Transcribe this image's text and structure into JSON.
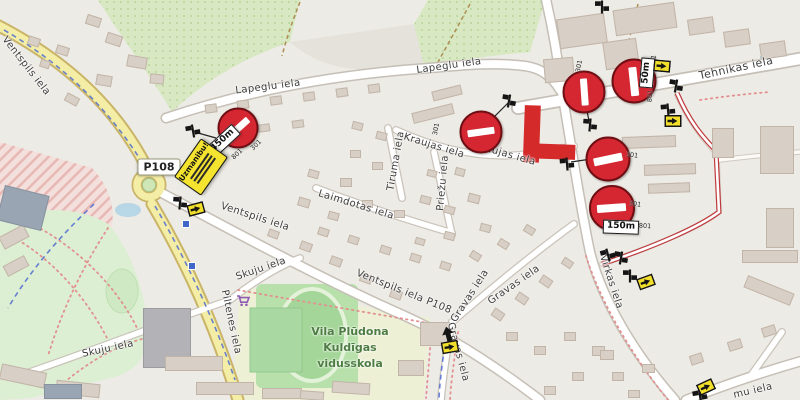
{
  "colors": {
    "closure": "#d42a2a",
    "route": "#bf3a3e",
    "no_entry": "#d42732",
    "detour_yellow": "#f2df2b",
    "warning_yellow": "#f4e32f",
    "primary_road": "#f3eda5",
    "school_text": "#4e7d43",
    "cycle_route": "#4f6bd0"
  },
  "badges": {
    "road_ref": "P108",
    "x": 159,
    "y": 167
  },
  "warning_sign": {
    "title": "Uzmanibu!",
    "x": 201,
    "y": 167,
    "rot": -55
  },
  "school_label": {
    "lines": [
      "Vila Plūdona",
      "Kuldīgas",
      "vidusskola"
    ],
    "x": 350,
    "y": 348
  },
  "street_labels": [
    {
      "id": "ventspils-nw",
      "text": "Ventspils iela",
      "x": 26,
      "y": 66,
      "rot": 52
    },
    {
      "id": "lapeglu-w",
      "text": "Lapeglu iela",
      "x": 268,
      "y": 87,
      "rot": -7
    },
    {
      "id": "lapeglu-e",
      "text": "Lapeglu iela",
      "x": 449,
      "y": 66,
      "rot": -8
    },
    {
      "id": "tehnikas",
      "text": "Tehnikas iela",
      "x": 736,
      "y": 68,
      "rot": -12,
      "size": 11
    },
    {
      "id": "kraujas-w",
      "text": "Kraujas iela",
      "x": 434,
      "y": 146,
      "rot": 17
    },
    {
      "id": "kraujas-e",
      "text": "Kraujas iela",
      "x": 505,
      "y": 154,
      "rot": 16
    },
    {
      "id": "tiruma",
      "text": "Tiruma iela",
      "x": 396,
      "y": 161,
      "rot": -80
    },
    {
      "id": "priezu",
      "text": "Priežu iela",
      "x": 443,
      "y": 183,
      "rot": -85
    },
    {
      "id": "laimdotas",
      "text": "Laimdotas iela",
      "x": 356,
      "y": 205,
      "rot": 17
    },
    {
      "id": "ventspils-c",
      "text": "Ventspils iela",
      "x": 255,
      "y": 217,
      "rot": 18
    },
    {
      "id": "ventspils-s",
      "text": "Ventspils iela    P108",
      "x": 404,
      "y": 292,
      "rot": 22
    },
    {
      "id": "skuju-ne",
      "text": "Skuju iela",
      "x": 261,
      "y": 269,
      "rot": -19
    },
    {
      "id": "skuju-sw",
      "text": "Skuju iela",
      "x": 108,
      "y": 349,
      "rot": -12
    },
    {
      "id": "piltenes",
      "text": "Piltenes iela",
      "x": 231,
      "y": 322,
      "rot": 78
    },
    {
      "id": "virkas",
      "text": "Virkas iela",
      "x": 611,
      "y": 282,
      "rot": 72
    },
    {
      "id": "gravas-n",
      "text": "Gravas iela",
      "x": 470,
      "y": 296,
      "rot": -57
    },
    {
      "id": "gravas-ne",
      "text": "Gravas iela",
      "x": 514,
      "y": 285,
      "rot": -35
    },
    {
      "id": "gravas-s",
      "text": "Gravas iela",
      "x": 458,
      "y": 352,
      "rot": 75
    },
    {
      "id": "mu",
      "text": "mu iela",
      "x": 753,
      "y": 391,
      "rot": -13
    }
  ],
  "no_entry_signs": [
    {
      "x": 238,
      "y": 128,
      "bar": -42,
      "size": 37,
      "code": "301",
      "cdx": 18,
      "cdy": 17,
      "crot": -45
    },
    {
      "x": 481,
      "y": 132,
      "bar": -8,
      "size": 39,
      "code": "301",
      "cdx": -45,
      "cdy": -3,
      "crot": -80
    },
    {
      "x": 584,
      "y": 92,
      "bar": 86,
      "size": 39,
      "code": "301",
      "cdx": -5,
      "cdy": -26,
      "crot": -80
    },
    {
      "x": 634,
      "y": 81,
      "bar": 84,
      "size": 41,
      "code": "301",
      "cdx": 19,
      "cdy": -20,
      "crot": -80
    },
    {
      "x": 608,
      "y": 159,
      "bar": -12,
      "size": 41,
      "code": "301",
      "cdx": 24,
      "cdy": -4,
      "crot": 8
    },
    {
      "x": 612,
      "y": 208,
      "bar": -4,
      "size": 42,
      "code": "301",
      "cdx": 23,
      "cdy": -4,
      "crot": 8
    }
  ],
  "distance_plates": [
    {
      "text": "450m",
      "x": 223,
      "y": 141,
      "rot": -43,
      "code": "801",
      "cdx": 14,
      "cdy": 13
    },
    {
      "text": "50m",
      "x": 647,
      "y": 73,
      "rot": -85,
      "code": "801",
      "cdx": 3,
      "cdy": 23
    },
    {
      "text": "150m",
      "x": 621,
      "y": 227,
      "rot": 2,
      "code": "801",
      "cdx": 24,
      "cdy": -1
    }
  ],
  "signpost_icons": [
    [
      193,
      131,
      -10
    ],
    [
      180,
      203,
      5
    ],
    [
      509,
      101,
      10
    ],
    [
      590,
      125,
      5
    ],
    [
      567,
      164,
      -5
    ],
    [
      676,
      86,
      10
    ],
    [
      668,
      110,
      -5
    ],
    [
      602,
      7,
      0
    ],
    [
      608,
      255,
      -15
    ],
    [
      621,
      258,
      10
    ],
    [
      630,
      276,
      0
    ],
    [
      700,
      396,
      -10
    ]
  ],
  "detour_signs": [
    [
      196,
      209,
      -15
    ],
    [
      662,
      66,
      5
    ],
    [
      673,
      121,
      0
    ],
    [
      646,
      282,
      -20
    ],
    [
      706,
      387,
      -25
    ],
    [
      450,
      347,
      -10
    ]
  ],
  "arrow_icons": [
    [
      448,
      334,
      -15
    ]
  ],
  "bus_stops": [
    [
      186,
      224
    ],
    [
      192,
      266
    ]
  ],
  "poi": {
    "supermarket": {
      "x": 243,
      "y": 301
    }
  },
  "buildings": [
    [
      86,
      16,
      15,
      10,
      18
    ],
    [
      106,
      34,
      16,
      11,
      18
    ],
    [
      56,
      46,
      13,
      9,
      18
    ],
    [
      127,
      56,
      20,
      12,
      10
    ],
    [
      96,
      75,
      16,
      11,
      10
    ],
    [
      28,
      37,
      12,
      9,
      18
    ],
    [
      150,
      74,
      14,
      10,
      6
    ],
    [
      65,
      95,
      14,
      9,
      28
    ],
    [
      40,
      60,
      10,
      8,
      18
    ],
    [
      205,
      104,
      12,
      9,
      -8
    ],
    [
      237,
      100,
      12,
      9,
      -8
    ],
    [
      270,
      96,
      12,
      9,
      -8
    ],
    [
      303,
      92,
      12,
      9,
      -8
    ],
    [
      336,
      88,
      12,
      9,
      -8
    ],
    [
      368,
      84,
      12,
      9,
      -8
    ],
    [
      224,
      128,
      12,
      8,
      -8
    ],
    [
      258,
      124,
      12,
      8,
      -8
    ],
    [
      292,
      120,
      12,
      8,
      -8
    ],
    [
      412,
      108,
      42,
      11,
      -14
    ],
    [
      432,
      88,
      30,
      10,
      -14
    ],
    [
      352,
      122,
      11,
      8,
      14
    ],
    [
      376,
      132,
      11,
      8,
      14
    ],
    [
      350,
      150,
      11,
      8,
      0
    ],
    [
      372,
      162,
      11,
      8,
      0
    ],
    [
      340,
      178,
      12,
      9,
      0
    ],
    [
      308,
      170,
      11,
      8,
      16
    ],
    [
      298,
      198,
      12,
      9,
      16
    ],
    [
      328,
      212,
      11,
      8,
      16
    ],
    [
      362,
      200,
      11,
      8,
      0
    ],
    [
      394,
      210,
      11,
      8,
      0
    ],
    [
      420,
      196,
      11,
      8,
      14
    ],
    [
      444,
      206,
      11,
      8,
      14
    ],
    [
      468,
      194,
      12,
      9,
      14
    ],
    [
      455,
      168,
      10,
      8,
      14
    ],
    [
      427,
      170,
      10,
      7,
      14
    ],
    [
      480,
      224,
      11,
      8,
      14
    ],
    [
      444,
      232,
      11,
      8,
      14
    ],
    [
      415,
      238,
      10,
      7,
      16
    ],
    [
      318,
      228,
      11,
      8,
      18
    ],
    [
      348,
      236,
      11,
      8,
      18
    ],
    [
      380,
      246,
      11,
      8,
      18
    ],
    [
      410,
      254,
      11,
      8,
      18
    ],
    [
      440,
      262,
      11,
      8,
      18
    ],
    [
      470,
      252,
      11,
      8,
      32
    ],
    [
      498,
      240,
      11,
      8,
      32
    ],
    [
      524,
      226,
      11,
      8,
      32
    ],
    [
      300,
      242,
      12,
      9,
      20
    ],
    [
      330,
      257,
      12,
      9,
      20
    ],
    [
      360,
      274,
      12,
      9,
      20
    ],
    [
      390,
      290,
      12,
      9,
      20
    ],
    [
      268,
      230,
      11,
      8,
      20
    ],
    [
      492,
      310,
      12,
      9,
      34
    ],
    [
      516,
      294,
      12,
      9,
      34
    ],
    [
      540,
      277,
      12,
      9,
      34
    ],
    [
      562,
      259,
      11,
      8,
      34
    ],
    [
      506,
      332,
      12,
      9,
      0
    ],
    [
      534,
      346,
      12,
      9,
      0
    ],
    [
      564,
      332,
      12,
      9,
      0
    ],
    [
      592,
      346,
      13,
      10,
      0
    ],
    [
      572,
      372,
      12,
      9,
      0
    ],
    [
      612,
      372,
      12,
      9,
      0
    ],
    [
      544,
      386,
      12,
      9,
      0
    ],
    [
      628,
      390,
      12,
      8,
      0
    ],
    [
      558,
      16,
      48,
      30,
      -8
    ],
    [
      614,
      6,
      62,
      26,
      -8
    ],
    [
      604,
      40,
      34,
      28,
      -8
    ],
    [
      688,
      18,
      26,
      16,
      -8
    ],
    [
      724,
      30,
      26,
      16,
      -8
    ],
    [
      760,
      42,
      26,
      16,
      -8
    ],
    [
      544,
      58,
      30,
      24,
      -5
    ],
    [
      622,
      136,
      54,
      12,
      -2
    ],
    [
      644,
      164,
      52,
      11,
      -2
    ],
    [
      648,
      183,
      42,
      10,
      -2
    ],
    [
      712,
      128,
      22,
      30,
      0
    ],
    [
      760,
      126,
      34,
      48,
      0
    ],
    [
      766,
      208,
      28,
      40,
      0
    ],
    [
      742,
      250,
      56,
      13,
      0
    ],
    [
      744,
      284,
      50,
      13,
      22
    ],
    [
      600,
      350,
      14,
      10,
      0
    ],
    [
      642,
      364,
      13,
      9,
      0
    ],
    [
      690,
      354,
      13,
      10,
      -18
    ],
    [
      728,
      340,
      14,
      10,
      -18
    ],
    [
      762,
      326,
      14,
      10,
      -18
    ],
    [
      2,
      200,
      30,
      16,
      -28
    ],
    [
      0,
      230,
      28,
      14,
      -28
    ],
    [
      4,
      260,
      24,
      12,
      -28
    ],
    [
      0,
      368,
      46,
      16,
      12
    ],
    [
      56,
      382,
      44,
      14,
      6
    ],
    [
      143,
      308,
      48,
      60,
      0,
      1
    ],
    [
      165,
      356,
      58,
      15,
      0
    ],
    [
      196,
      382,
      58,
      13,
      0
    ],
    [
      262,
      388,
      40,
      11,
      0
    ],
    [
      44,
      384,
      38,
      15,
      0,
      2
    ],
    [
      0,
      190,
      46,
      36,
      14,
      2
    ],
    [
      420,
      322,
      30,
      24,
      0
    ],
    [
      398,
      360,
      26,
      16,
      0
    ],
    [
      332,
      382,
      38,
      12,
      4
    ],
    [
      300,
      391,
      24,
      9,
      4
    ]
  ]
}
